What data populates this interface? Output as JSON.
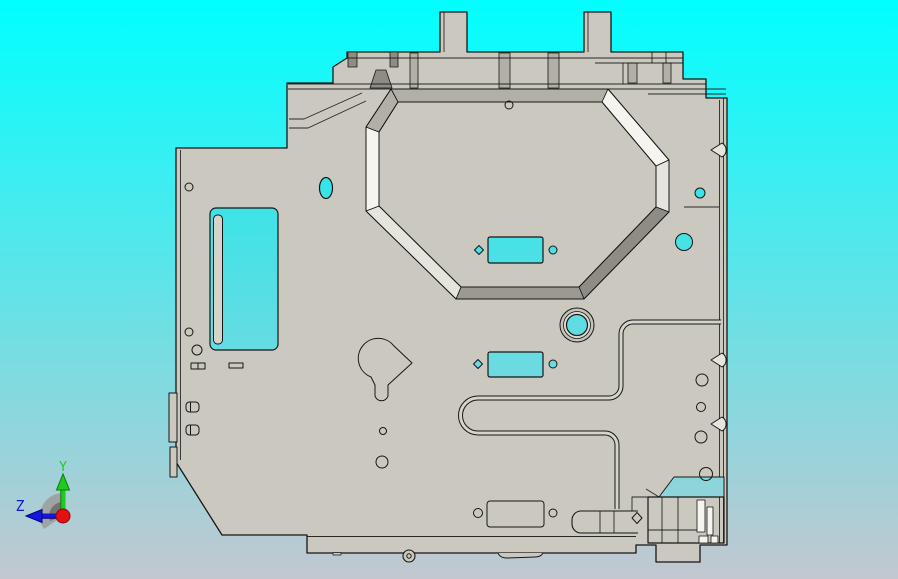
{
  "triad": {
    "y_label": "Y",
    "z_label": "Z"
  },
  "colors": {
    "bg_top": "#00ffff",
    "bg_bottom": "#c3c7d0",
    "part_face": "#cbc9bf",
    "part_light": "#e6e5dd",
    "part_highlight": "#f5f4ef",
    "part_mid": "#b2b0a6",
    "part_dark": "#8e8c84",
    "part_darker": "#9b9991",
    "strip": "#d6d4ca",
    "outline": "#161616",
    "hole_top": "#00eff1",
    "hole_bottom": "#a9cfd7",
    "axis_y": "#1ecb1e",
    "axis_y_dark": "#0d7a0d",
    "axis_z": "#1616d9",
    "axis_z_dark": "#00008a",
    "origin_red": "#e31212",
    "origin_dark": "#8a0808",
    "disc": "#9c9c9c",
    "disc_dark": "#6f6f6f"
  }
}
